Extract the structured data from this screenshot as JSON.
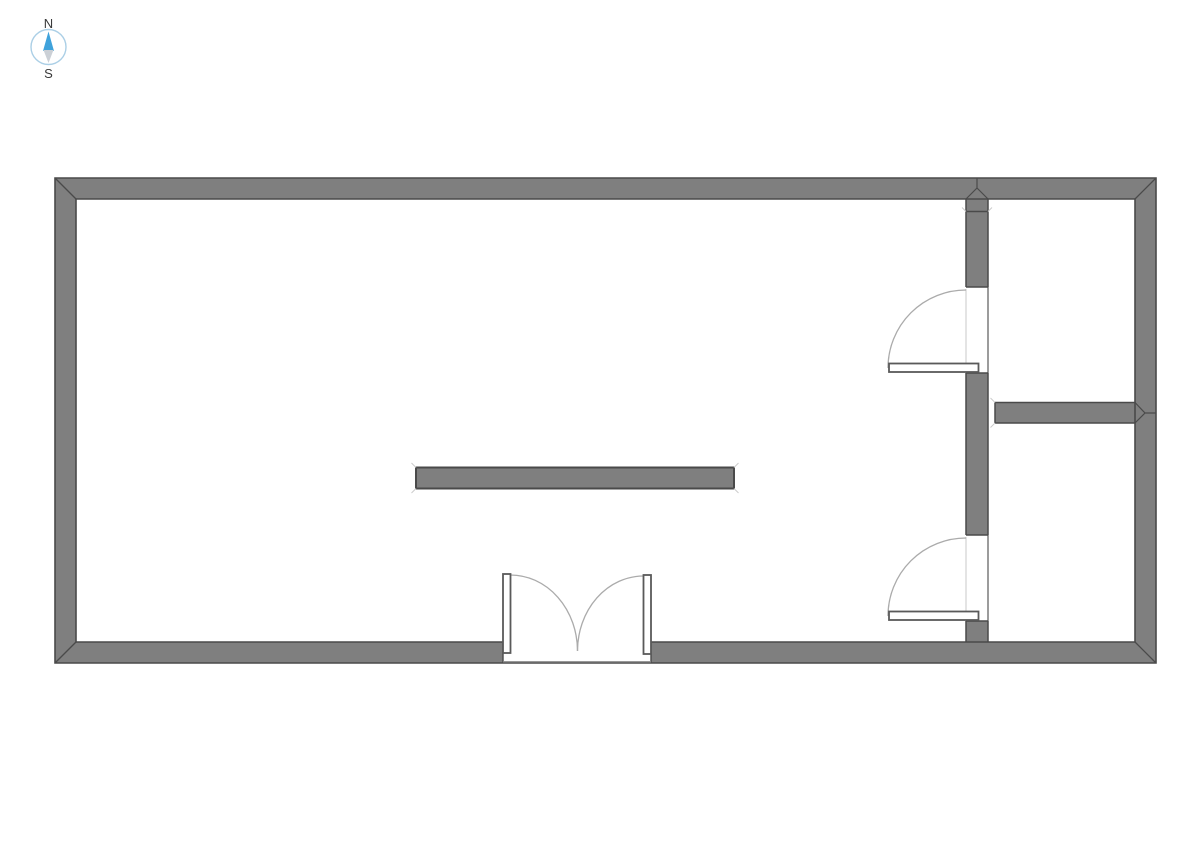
{
  "page": {
    "width": 1191,
    "height": 842,
    "background": "#ffffff",
    "title": "Floor plan"
  },
  "compass": {
    "north_label": "N",
    "south_label": "S",
    "cx": 48.5,
    "cy": 47,
    "radius": 17.5,
    "ring_color": "#abcfe6",
    "needle_north_color": "#3fa2db",
    "needle_south_color": "#cbd0d6",
    "label_color": "#3a3a3a",
    "north_label_y": 28,
    "south_label_y": 78,
    "needle_north_points": "48.5,31.5 54,51 43,51",
    "needle_south_points": "43.5,50 53.5,50 48.5,63"
  },
  "plan": {
    "colors": {
      "wall_fill": "#7f7f7f",
      "wall_edge": "#4a4a4a",
      "leaf_fill": "#ffffff",
      "leaf_edge": "#5a5a5a",
      "arc": "#ababab",
      "face_light": "#c8c8c8",
      "face_dark": "#5a5a5a",
      "tick": "#cccccc",
      "sill": "#8a8a8a"
    },
    "elements": [
      {
        "type": "path",
        "name": "exterior-walls",
        "fill": "wall_fill",
        "fill_rule": "evenodd",
        "d": "M55 178 H1156 V663 H55 Z M76 199 H1135 V642 H651 V663 H503 V642 H76 Z"
      },
      {
        "type": "rect",
        "name": "interior-wall-upper-segment",
        "fill": "wall_fill",
        "x": 966,
        "y": 199,
        "w": 22,
        "h": 88
      },
      {
        "type": "rect",
        "name": "interior-wall-middle-segment",
        "fill": "wall_fill",
        "x": 966,
        "y": 373,
        "w": 22,
        "h": 162
      },
      {
        "type": "rect",
        "name": "interior-wall-lower-segment",
        "fill": "wall_fill",
        "x": 966,
        "y": 621,
        "w": 22,
        "h": 21
      },
      {
        "type": "rect",
        "name": "partition-wall-east",
        "fill": "wall_fill",
        "x": 995,
        "y": 402.5,
        "w": 140,
        "h": 20.5
      },
      {
        "type": "rect",
        "name": "freestanding-wall-bar",
        "fill": "wall_fill",
        "stroke": "wall_edge",
        "sw": 2,
        "x": 416,
        "y": 467.5,
        "w": 318,
        "h": 21
      },
      {
        "type": "path",
        "name": "door-1-opening-face-line",
        "stroke": "face_light",
        "sw": 1,
        "d": "M966 289 V363"
      },
      {
        "type": "path",
        "name": "door-2-opening-face-line",
        "stroke": "face_light",
        "sw": 1,
        "d": "M966 537 V611"
      },
      {
        "type": "path",
        "name": "door-1-opening-back-line",
        "stroke": "face_dark",
        "sw": 1.2,
        "d": "M988 287 V373"
      },
      {
        "type": "path",
        "name": "door-2-opening-back-line",
        "stroke": "face_dark",
        "sw": 1.2,
        "d": "M988 535 V621"
      },
      {
        "type": "path",
        "name": "door-1-swing-arc",
        "stroke": "arc",
        "sw": 1.3,
        "d": "M966 290 A78 78 0 0 0 888 368"
      },
      {
        "type": "path",
        "name": "door-2-swing-arc",
        "stroke": "arc",
        "sw": 1.3,
        "d": "M966 538 A78 78 0 0 0 888 616"
      },
      {
        "type": "path",
        "name": "double-door-left-swing-arc",
        "stroke": "arc",
        "sw": 1.3,
        "d": "M510.5 575 A67 76 0 0 1 577.5 651"
      },
      {
        "type": "path",
        "name": "double-door-right-swing-arc",
        "stroke": "arc",
        "sw": 1.3,
        "d": "M643.5 576 A66 75 0 0 0 577.5 651"
      },
      {
        "type": "path",
        "name": "exterior-outer-outline",
        "stroke": "wall_edge",
        "sw": 1.6,
        "d": "M55 178 H1156 V663 H55 Z"
      },
      {
        "type": "path",
        "name": "exterior-inner-outline",
        "stroke": "wall_edge",
        "sw": 1.6,
        "d": "M76 199 H1135 M76 199 V642 M1135 199 V642 M76 642 H503 M651 642 H1135"
      },
      {
        "type": "path",
        "name": "corner-miter-lines",
        "stroke": "wall_edge",
        "sw": 1.3,
        "d": "M55 178 L76 199 M1156 178 L1135 199 M55 663 L76 642 M1156 663 L1135 642"
      },
      {
        "type": "path",
        "name": "entry-jamb-lines",
        "stroke": "wall_edge",
        "sw": 1.4,
        "d": "M503 642 V663 M651 642 V663"
      },
      {
        "type": "path",
        "name": "entry-sill-line",
        "stroke": "sill",
        "sw": 1.4,
        "d": "M503 661.8 H651"
      },
      {
        "type": "path",
        "name": "interior-wall-edges",
        "stroke": "wall_edge",
        "sw": 1.5,
        "d": "M966 199 V287 M966 373 V535 M966 621 V642 M988 199 V287 M988 373 V535 M988 621 V642 M966 287 H988 M966 373 H988 M966 535 H988 M966 621 H988"
      },
      {
        "type": "path",
        "name": "interior-wall-join-line",
        "stroke": "wall_edge",
        "sw": 1.4,
        "d": "M966 211.5 H988"
      },
      {
        "type": "path",
        "name": "interior-wall-top-miter",
        "stroke": "wall_edge",
        "sw": 1.2,
        "d": "M966 199 L977 188 M988 199 L977 188 M977 188 V178"
      },
      {
        "type": "path",
        "name": "partition-wall-edges",
        "stroke": "wall_edge",
        "sw": 1.5,
        "d": "M995 402.5 H1135 M995 423 H1135 M995 402.5 V423"
      },
      {
        "type": "path",
        "name": "partition-wall-right-miter",
        "stroke": "wall_edge",
        "sw": 1.2,
        "d": "M1135 402.5 L1145 413 M1135 423 L1145 413 M1145 413 H1156"
      },
      {
        "type": "path",
        "name": "join-corner-ticks",
        "stroke": "tick",
        "sw": 1,
        "d": "M966 211.5 L962 207.5 M988 211.5 L992 207.5"
      },
      {
        "type": "path",
        "name": "bar-corner-ticks",
        "stroke": "tick",
        "sw": 1,
        "d": "M416 467.5 L411.5 463 M734 467.5 L738.5 463 M416 488.5 L411.5 493 M734 488.5 L738.5 493"
      },
      {
        "type": "path",
        "name": "partition-corner-ticks",
        "stroke": "tick",
        "sw": 1,
        "d": "M995 402.5 L990.5 398 M995 423 L990.5 427.5"
      },
      {
        "type": "rect",
        "name": "door-1-leaf",
        "fill": "leaf_fill",
        "stroke": "leaf_edge",
        "sw": 1.8,
        "x": 889,
        "y": 363.5,
        "w": 89.5,
        "h": 8.5
      },
      {
        "type": "rect",
        "name": "door-2-leaf",
        "fill": "leaf_fill",
        "stroke": "leaf_edge",
        "sw": 1.8,
        "x": 889,
        "y": 611.5,
        "w": 89.5,
        "h": 8.5
      },
      {
        "type": "rect",
        "name": "double-door-left-leaf",
        "fill": "leaf_fill",
        "stroke": "leaf_edge",
        "sw": 1.8,
        "x": 503,
        "y": 574,
        "w": 7.5,
        "h": 79
      },
      {
        "type": "rect",
        "name": "double-door-right-leaf",
        "fill": "leaf_fill",
        "stroke": "leaf_edge",
        "sw": 1.8,
        "x": 643.5,
        "y": 575,
        "w": 7.5,
        "h": 79
      }
    ]
  }
}
